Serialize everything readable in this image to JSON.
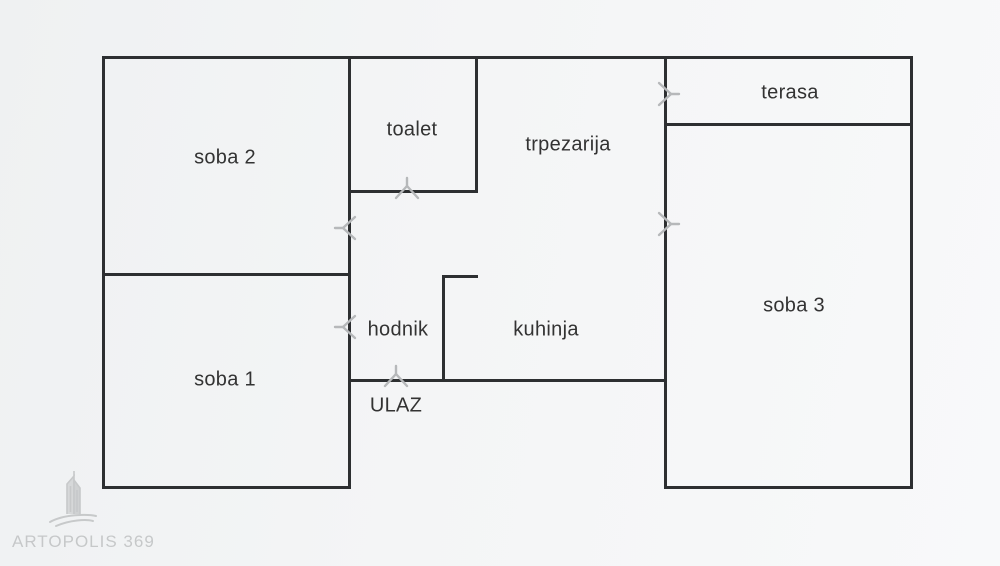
{
  "app": {
    "type": "apartment-floor-plan"
  },
  "canvas": {
    "width": 1000,
    "height": 566,
    "bg_left": "#eff1f2",
    "bg_right": "#f8f9fa"
  },
  "style": {
    "wall_color": "#2d2f31",
    "wall_thickness": 3,
    "door_mark_color": "#b6b8ba",
    "label_color": "#333333",
    "label_font_size": 20
  },
  "rooms": [
    {
      "id": "soba-2",
      "label": "soba 2",
      "cx": 225,
      "cy": 158
    },
    {
      "id": "toalet",
      "label": "toalet",
      "cx": 412,
      "cy": 130
    },
    {
      "id": "trpezarija",
      "label": "trpezarija",
      "cx": 568,
      "cy": 145
    },
    {
      "id": "terasa",
      "label": "terasa",
      "cx": 790,
      "cy": 93
    },
    {
      "id": "soba-3",
      "label": "soba 3",
      "cx": 794,
      "cy": 306
    },
    {
      "id": "soba-1",
      "label": "soba 1",
      "cx": 225,
      "cy": 380
    },
    {
      "id": "hodnik",
      "label": "hodnik",
      "cx": 398,
      "cy": 330
    },
    {
      "id": "kuhinja",
      "label": "kuhinja",
      "cx": 546,
      "cy": 330
    },
    {
      "id": "ulaz",
      "label": "ULAZ",
      "cx": 396,
      "cy": 406
    }
  ],
  "walls": [
    {
      "id": "outer-top",
      "x": 102,
      "y": 56,
      "w": 811,
      "h": 3
    },
    {
      "id": "outer-left",
      "x": 102,
      "y": 56,
      "w": 3,
      "h": 433
    },
    {
      "id": "outer-right",
      "x": 910,
      "y": 56,
      "w": 3,
      "h": 433
    },
    {
      "id": "soba1-bottom",
      "x": 102,
      "y": 486,
      "w": 249,
      "h": 3
    },
    {
      "id": "soba3-bottom",
      "x": 664,
      "y": 486,
      "w": 249,
      "h": 3
    },
    {
      "id": "mid-left-vertical",
      "x": 348,
      "y": 56,
      "w": 3,
      "h": 433
    },
    {
      "id": "mid-right-vertical",
      "x": 664,
      "y": 56,
      "w": 3,
      "h": 433
    },
    {
      "id": "soba1-soba2-divider",
      "x": 102,
      "y": 273,
      "w": 249,
      "h": 3
    },
    {
      "id": "toalet-right",
      "x": 475,
      "y": 56,
      "w": 3,
      "h": 137
    },
    {
      "id": "toalet-bottom",
      "x": 348,
      "y": 190,
      "w": 130,
      "h": 3
    },
    {
      "id": "terasa-bottom",
      "x": 664,
      "y": 123,
      "w": 249,
      "h": 3
    },
    {
      "id": "entry-bottom",
      "x": 348,
      "y": 379,
      "w": 319,
      "h": 3
    },
    {
      "id": "kuhinja-partition",
      "x": 442,
      "y": 275,
      "w": 3,
      "h": 107
    },
    {
      "id": "kuhinja-stub",
      "x": 442,
      "y": 275,
      "w": 36,
      "h": 3
    }
  ],
  "doors": [
    {
      "id": "toalet-door",
      "x": 407,
      "y": 192,
      "dir": "up"
    },
    {
      "id": "soba2-door",
      "x": 349,
      "y": 228,
      "dir": "left"
    },
    {
      "id": "hodnik-door",
      "x": 349,
      "y": 327,
      "dir": "left"
    },
    {
      "id": "ulaz-door",
      "x": 396,
      "y": 380,
      "dir": "up"
    },
    {
      "id": "terasa-door",
      "x": 665,
      "y": 94,
      "dir": "right"
    },
    {
      "id": "soba3-door",
      "x": 665,
      "y": 224,
      "dir": "right"
    }
  ],
  "watermark": {
    "text": "ARTOPOLIS 369",
    "color": "#c6c8c9",
    "logo": "skyscraper-swoosh"
  }
}
